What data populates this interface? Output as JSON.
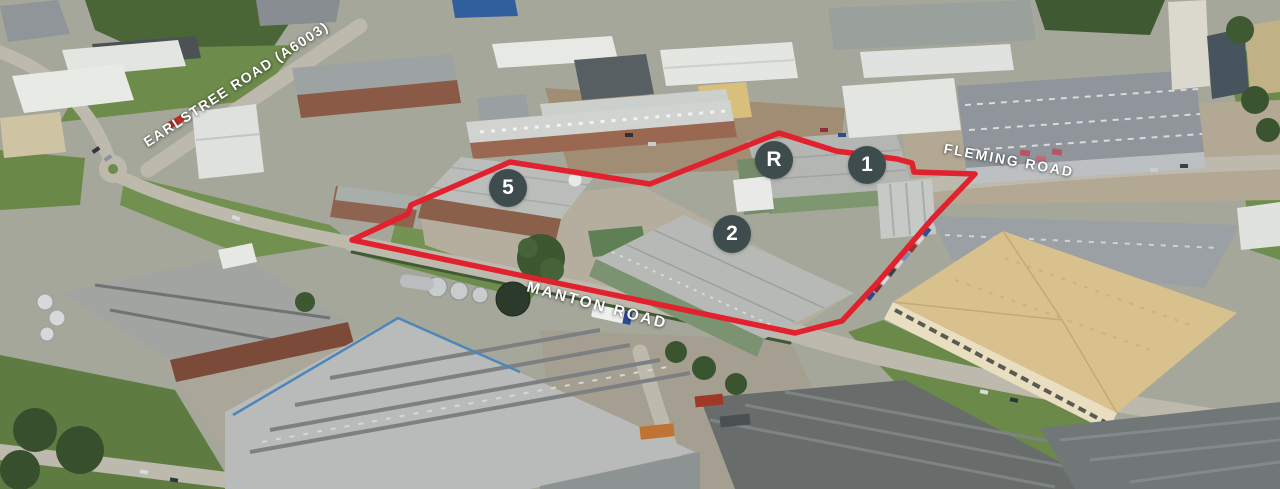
{
  "annotations": {
    "boundary": {
      "color": "#e1222e"
    },
    "road_labels": [
      {
        "id": "earlstree",
        "text": "EARLSTREE ROAD (A6003)"
      },
      {
        "id": "fleming",
        "text": "FLEMING ROAD"
      },
      {
        "id": "manton",
        "text": "MANTON ROAD"
      }
    ],
    "markers": [
      {
        "label": "5"
      },
      {
        "label": "R"
      },
      {
        "label": "1"
      },
      {
        "label": "2"
      }
    ],
    "marker_style": {
      "background": "#3e4c4e",
      "text_color": "#ffffff"
    },
    "label_style": {
      "color": "#ffffff"
    }
  }
}
